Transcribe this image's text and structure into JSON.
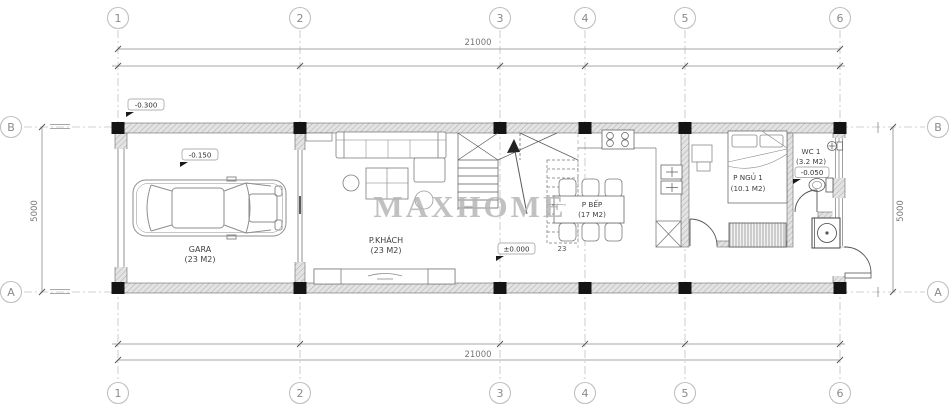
{
  "watermark": {
    "text": "MAXHOME"
  },
  "grid": {
    "cols": [
      "1",
      "2",
      "3",
      "4",
      "5",
      "6"
    ],
    "rows": [
      "B",
      "A"
    ]
  },
  "dims": {
    "top": "21000",
    "bottom": "21000",
    "left": "5000",
    "right": "5000"
  },
  "levels": {
    "outdoor": "-0.300",
    "garage": "-0.150",
    "ground": "±0.000",
    "wc": "-0.050"
  },
  "rooms": [
    {
      "name": "GARA",
      "area": "(23 M2)"
    },
    {
      "name": "P.KHÁCH",
      "area": "(23 M2)"
    },
    {
      "name": "P BẾP",
      "area": "(17 M2)"
    },
    {
      "name": "P NGỦ 1",
      "area": "(10.1 M2)"
    },
    {
      "name": "WC 1",
      "area": "(3.2 M2)"
    }
  ],
  "stairs": {
    "label": "23"
  },
  "colors": {
    "line": "#555555",
    "wall_fill": "#e3e3e3",
    "column": "#141414",
    "grid_line": "#c2c2c2",
    "watermark": "#b4b4b4",
    "dim_text": "#777777"
  }
}
